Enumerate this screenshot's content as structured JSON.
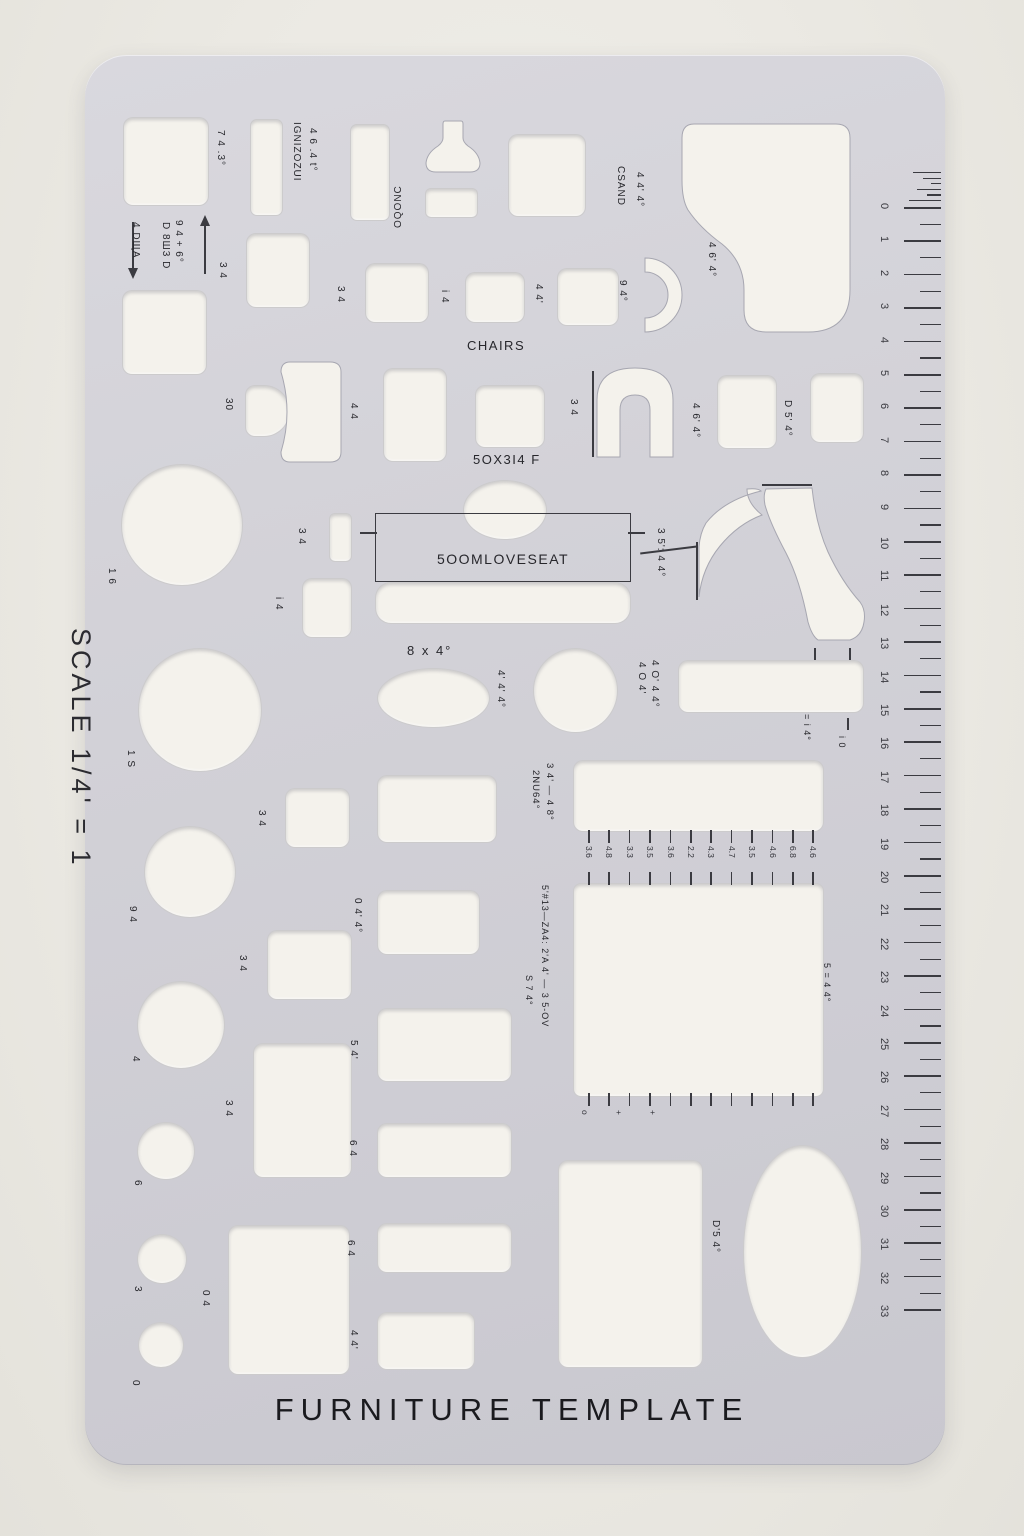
{
  "photo": {
    "background": "#ebe9e3",
    "plastic": "#d2d1d7",
    "hole_color": "#f4f2ec",
    "ink": "#27272c"
  },
  "title": "FURNITURE TEMPLATE",
  "scale": "SCALE 1/4' = 1",
  "sections": {
    "chairs": "CHAIRS",
    "loveseat": "5OOMLOVESEAT",
    "loveseat_dim": "5OX3I4 F",
    "oval_dim": "8 x 4°"
  },
  "labels": {
    "sq743": "7 4 .3°",
    "kingsize": "IGNIZOZUI",
    "l464t": "4 6 .4 t°",
    "oblong": "OQONC",
    "arrow_down": "4 DЩA",
    "arrow_up1": "D 8Ш3 D",
    "arrow_up2": "9 4 + 6°",
    "grand": "CSAND",
    "grand_dim": "4 4' 4°",
    "grand_dim2": "4 6' 4°",
    "arc94": "9 4°",
    "r30": "30",
    "r44": "4 4",
    "r34a": "3 4",
    "r34b": "3 4",
    "r34c": "3 4",
    "r34d": "3 4",
    "r34e": "3 4",
    "r34f": "3 4",
    "ri4a": "i 4",
    "ri4b": "i 4",
    "r44q": "4 4'",
    "row3_34": "3 4",
    "row3_464": "4 6' 4°",
    "row3_d54": "D 5' 4°",
    "c16a": "1 6",
    "c16b": "1 S",
    "c94": "9 4",
    "c4": "4",
    "c6": "6",
    "c3": "3",
    "c0": "0",
    "sec3544": "3 5': 4 4°",
    "circ444": "4' 4' 4°",
    "tbl404": "4 O 4'",
    "tbl4044": "4 O' 4 4°",
    "tbl_i4": "= i 4°",
    "tbl_i0": "i 0",
    "queen1": "3 4' — 4 8°",
    "queen2": "2NU64°",
    "sofa044": "0 4' 4°",
    "king1": "5'#13—ZA4:  2'A 4' — 3 5-OV",
    "king2": "S 7 4°",
    "king3": "5 = 4 4°",
    "r54": "5 4'",
    "r64a": "6 4",
    "r64b": "6 4",
    "r44b": "4 4'",
    "r04a": "0 4",
    "ell_d54": "D'5 4°"
  },
  "bed_ticks": {
    "top": [
      "3.6",
      "4.8",
      "3.3",
      "3.5",
      "3.6",
      "2.2",
      "4.3",
      "4.7",
      "3.5",
      "4.6",
      "6.8",
      "4.6"
    ],
    "bottom": [
      "o",
      "+",
      "+"
    ]
  },
  "ruler": {
    "min": 0,
    "max": 33
  }
}
